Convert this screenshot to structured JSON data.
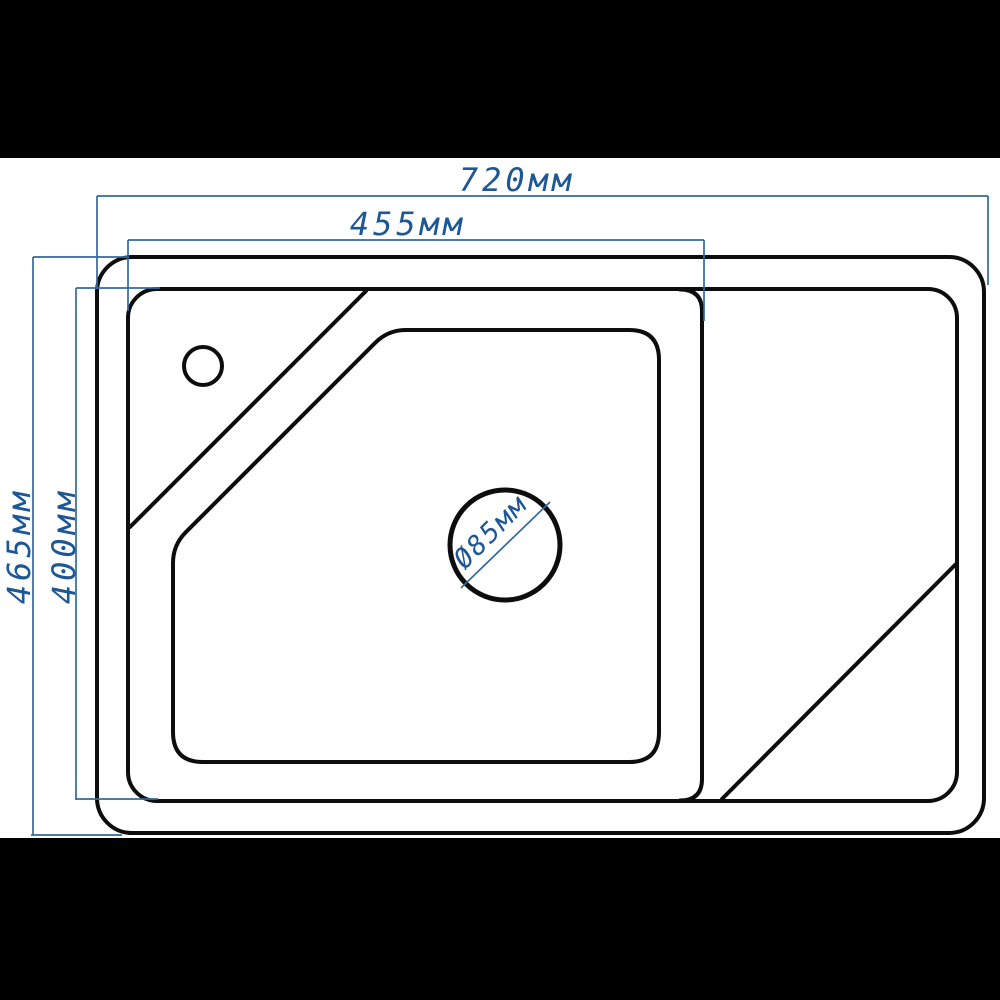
{
  "colors": {
    "dimension_blue": "#34699c",
    "text_blue": "#1d5795",
    "outline_black": "#0d0d0d",
    "background": "#ffffff",
    "letterbox": "#000000"
  },
  "diagram": {
    "unit": "мм",
    "dimensions": {
      "outer_width": "720мм",
      "bowl_width": "455мм",
      "outer_depth": "465мм",
      "bowl_depth": "400мм",
      "drain_diameter": "Ø85мм"
    },
    "values": {
      "outer_width_mm": 720,
      "bowl_width_mm": 455,
      "outer_depth_mm": 465,
      "bowl_depth_mm": 400,
      "drain_diameter_mm": 85
    }
  }
}
